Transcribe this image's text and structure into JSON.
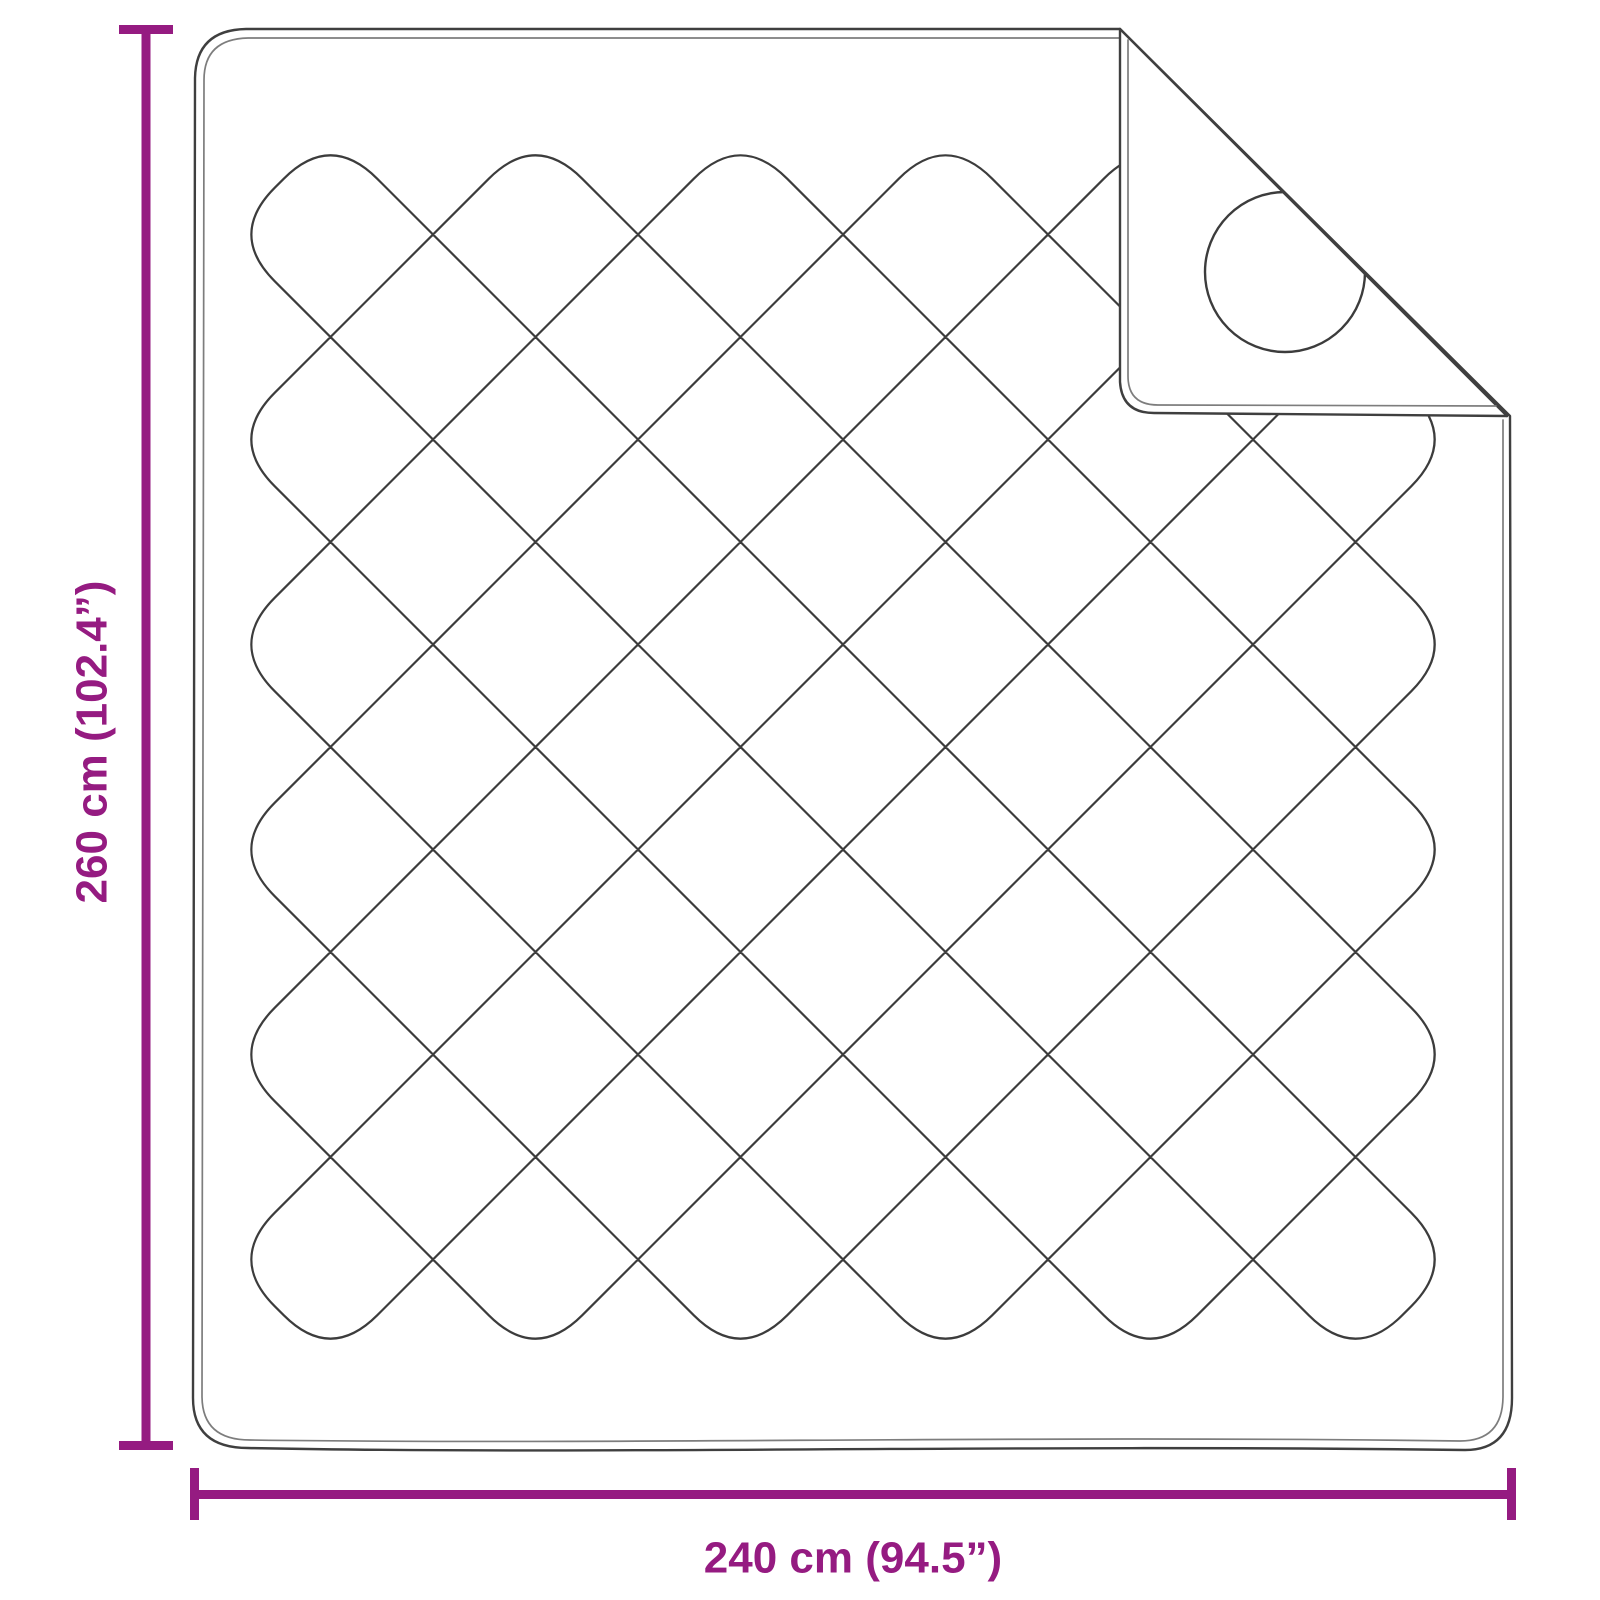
{
  "diagram": {
    "height_label": "260 cm (102.4”)",
    "width_label": "240 cm (94.5”)"
  },
  "colors": {
    "dimension_accent": "#951B81",
    "outline": "#3f3f3f",
    "outline_soft": "#7d7d7d",
    "quilt_line": "#3c3c3c",
    "background": "#ffffff"
  }
}
